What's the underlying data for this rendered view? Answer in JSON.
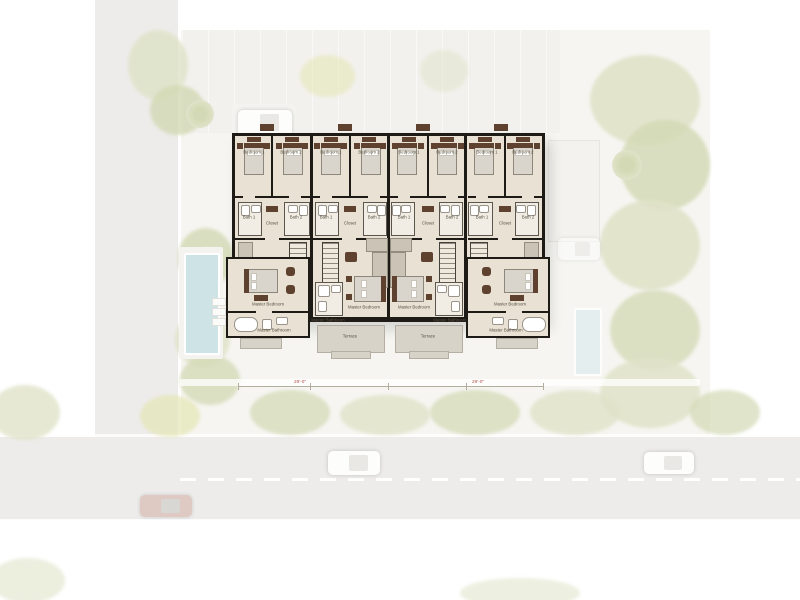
{
  "palette": {
    "wall": "#1e1b17",
    "floor": "#e9e1d4",
    "terrace": "#d8d3c9",
    "brown": "#5f4130",
    "mattress": "#d9d5cc",
    "road": "#edecea",
    "foliage": "#e0e3c9",
    "foliageDark": "#d3d9b4",
    "foliageYellow": "#e4e6b4",
    "poolLeft": "#cde3e5",
    "poolRight": "#e0edee",
    "dimRed": "#b5524e"
  },
  "icons": {
    "car_icon": "rounded-rect-with-windshield",
    "palm_tree_icon": "radial-green-circle",
    "pool_icon": "blue-rect",
    "lounger_icon": "small-white-rect",
    "stairs_icon": "hatched-rect"
  },
  "plan": {
    "units": [
      {
        "id": "unit-1",
        "labels": {
          "bedroom1": "Bedroom 1",
          "bedroom2": "Bedroom 2",
          "bath1": "Bath 1",
          "bath2": "Bath 2",
          "closet": "Closet",
          "master_bedroom": "Master Bedroom",
          "master_bathroom": "Master Bathroom"
        }
      },
      {
        "id": "unit-2",
        "labels": {
          "bedroom1": "Bedroom 1",
          "bedroom2": "Bedroom 2",
          "bath1": "Bath 1",
          "bath2": "Bath 2",
          "closet": "Closet",
          "master_bedroom": "Master Bedroom",
          "master_bathroom": "Master Bathroom",
          "terrace": "Terrace"
        }
      },
      {
        "id": "unit-3",
        "labels": {
          "bedroom1": "Bedroom 1",
          "bedroom2": "Bedroom 2",
          "bath1": "Bath 1",
          "bath2": "Bath 2",
          "closet": "Closet",
          "master_bedroom": "Master Bedroom",
          "master_bathroom": "Master Bathroom",
          "terrace": "Terrace"
        }
      },
      {
        "id": "unit-4",
        "labels": {
          "bedroom1": "Bedroom 1",
          "bedroom2": "Bedroom 2",
          "bath1": "Bath 1",
          "bath2": "Bath 2",
          "closet": "Closet",
          "master_bedroom": "Master Bedroom",
          "master_bathroom": "Master Bathroom"
        }
      }
    ],
    "dimensions": {
      "left": "29'-0\"",
      "right": "29'-0\""
    }
  }
}
